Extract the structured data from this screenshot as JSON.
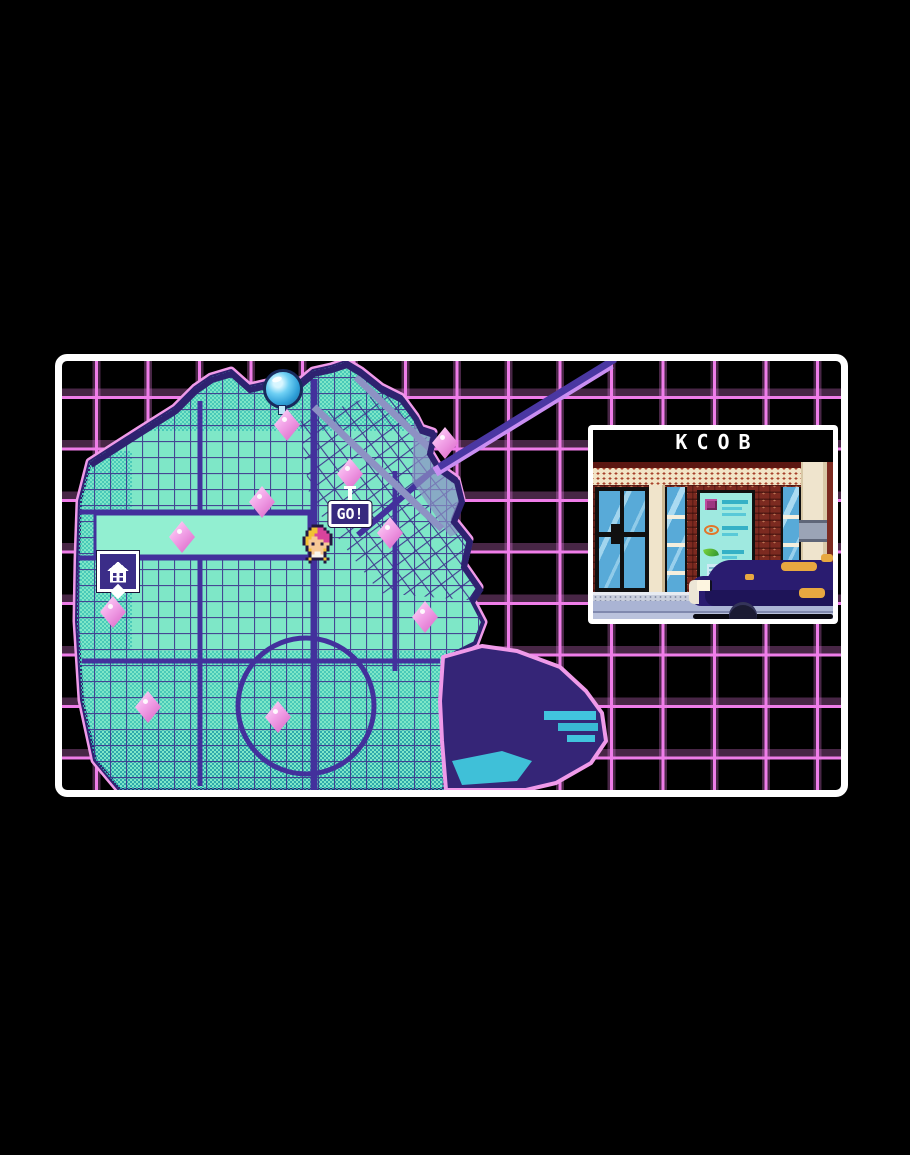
{
  "preview": {
    "title": "KCOB"
  },
  "map": {
    "go_label": "GO!",
    "markers": [
      {
        "type": "orb",
        "name": "objective-orb-marker",
        "x": 221,
        "y": 28
      },
      {
        "type": "diamond",
        "name": "location-marker",
        "x": 225,
        "y": 64
      },
      {
        "type": "diamond",
        "name": "destination-marker",
        "x": 288,
        "y": 113,
        "go": true
      },
      {
        "type": "diamond",
        "name": "location-marker",
        "x": 383,
        "y": 82
      },
      {
        "type": "diamond",
        "name": "location-marker",
        "x": 200,
        "y": 141
      },
      {
        "type": "diamond",
        "name": "location-marker",
        "x": 120,
        "y": 176
      },
      {
        "type": "diamond",
        "name": "location-marker",
        "x": 328,
        "y": 172
      },
      {
        "type": "diamond",
        "name": "location-marker",
        "x": 51,
        "y": 251
      },
      {
        "type": "diamond",
        "name": "location-marker",
        "x": 86,
        "y": 346
      },
      {
        "type": "diamond",
        "name": "location-marker",
        "x": 216,
        "y": 356
      },
      {
        "type": "diamond",
        "name": "location-marker",
        "x": 363,
        "y": 256
      },
      {
        "type": "home",
        "name": "home-marker",
        "x": 56,
        "y": 214
      },
      {
        "type": "player",
        "name": "player-marker",
        "x": 257,
        "y": 183
      }
    ],
    "player_sprite": [
      "...KKKK....",
      "..KYYMMK...",
      ".KYYYMMMK..",
      ".KYYMMMMMK.",
      "KYYFFMMMMK.",
      "KYFFFFFMMK.",
      "KYFKFFKFFK.",
      ".KFFFFFFK..",
      ".KYFFFFYK..",
      "..KFWWFK...",
      "..KWWWWK...",
      ".KYKKKKYK..",
      "..K....K..."
    ],
    "sprite_palette": {
      "K": "#231740",
      "Y": "#f2c133",
      "M": "#d8439c",
      "F": "#f6c896",
      "W": "#f8f4ec"
    }
  },
  "colors": {
    "grid": "#ef7de9",
    "land": "#7ee7c7",
    "streets": "#3b2b8a",
    "coast": "#f09ae9",
    "frame": "#ffffff",
    "marker_pink": "#f3a6e9",
    "marker_blue": "#3fb4e8",
    "panel_title_bg": "#000000",
    "panel_title_fg": "#ffffff"
  }
}
